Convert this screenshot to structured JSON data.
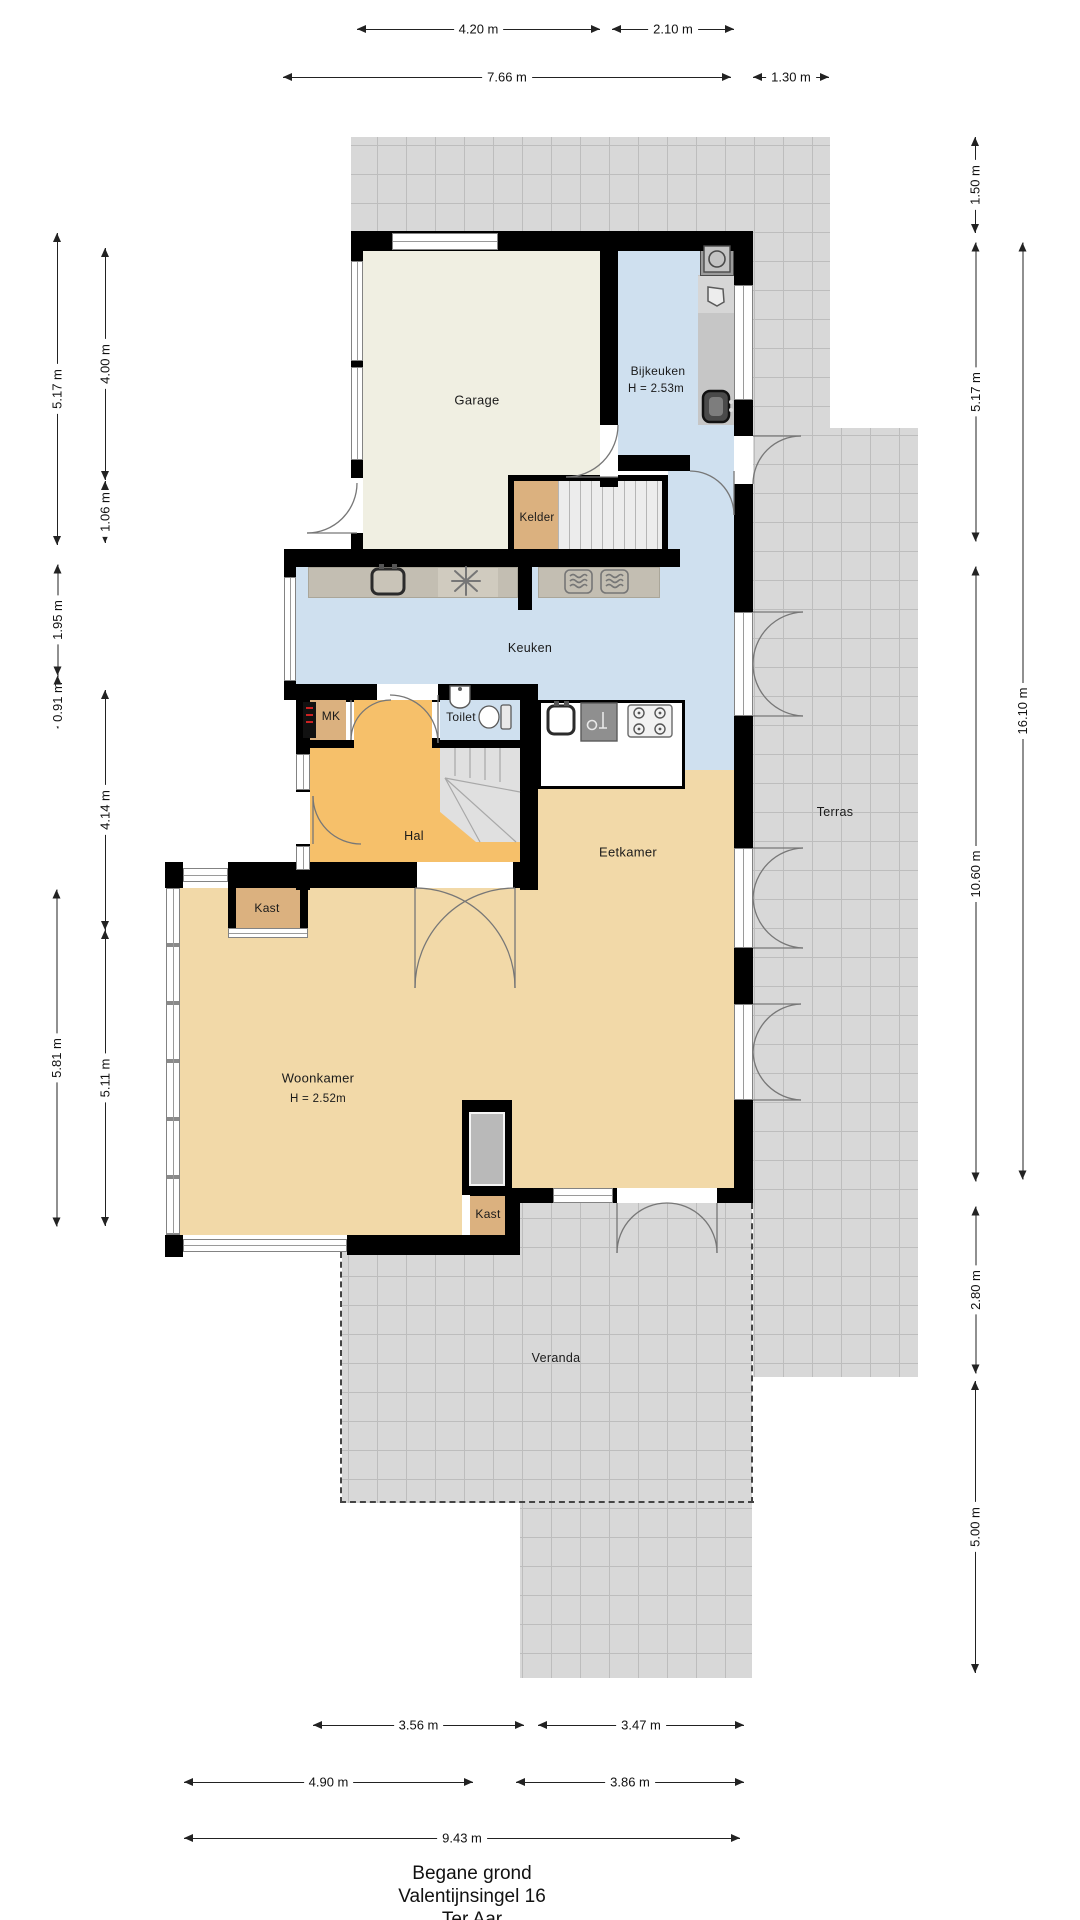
{
  "title": {
    "line1": "Begane grond",
    "line2": "Valentijnsingel 16",
    "line3": "Ter Aar"
  },
  "rooms": {
    "garage": "Garage",
    "bijkeuken": "Bijkeuken",
    "kelder": "Kelder",
    "keuken": "Keuken",
    "mk": "MK",
    "toilet": "Toilet",
    "hal": "Hal",
    "kast_hal": "Kast",
    "eetkamer": "Eetkamer",
    "woonkamer": "Woonkamer",
    "kast_woonkamer": "Kast",
    "terras": "Terras",
    "veranda": "Veranda"
  },
  "notes": {
    "bijkeuken_height": "H = 2.53m",
    "woonkamer_height": "H = 2.52m"
  },
  "dims": {
    "top": [
      "4.20 m",
      "2.10 m",
      "7.66 m",
      "1.30 m"
    ],
    "bottom": [
      "3.56 m",
      "3.47 m",
      "4.90 m",
      "3.86 m",
      "9.43 m"
    ],
    "left": [
      "5.17 m",
      "1.95 m",
      "0.91 m",
      "5.81 m",
      "4.00 m",
      "1.06 m",
      "4.14 m",
      "5.11 m"
    ],
    "right": [
      "1.50 m",
      "5.17 m",
      "10.60 m",
      "2.80 m",
      "5.00 m",
      "16.10 m"
    ]
  },
  "colors": {
    "wall": "#000000",
    "garage_floor": "#f0efe2",
    "wet_room_floor": "#cfe0ef",
    "hall_floor": "#f6c06a",
    "living_floor": "#f2d9a8",
    "closet_floor": "#dbb17f",
    "counter": "#c3beb2",
    "tiles": "#d8d8d8",
    "stairs": "#e0e0e0"
  },
  "icons": [
    "kitchen-sink-icon",
    "freezer-icon",
    "oven-icon",
    "microwave-icon",
    "washing-machine-icon",
    "laundry-basket-icon",
    "utility-sink-icon",
    "island-sink-icon",
    "dishwasher-icon",
    "gas-hob-icon",
    "toilet-icon",
    "hand-basin-icon",
    "fuse-box-icon",
    "fireplace-icon"
  ]
}
